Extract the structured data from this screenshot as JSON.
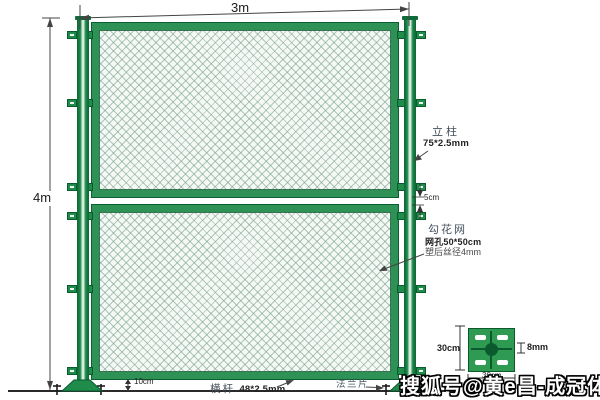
{
  "fence_dimensions": {
    "width": "3m",
    "height": "4m",
    "panel_gap": "5cm",
    "ground_clearance": "10cm"
  },
  "callouts": {
    "post_title": "立柱",
    "post_spec": "75*2.5mm",
    "mesh_title": "勾花网",
    "mesh_spec_opening": "网孔50*50cm",
    "mesh_spec_wire": "塑后丝径4mm",
    "rail_title": "横杆",
    "rail_spec": "48*2.5mm",
    "flange_title": "法兰片"
  },
  "flange_detail": {
    "height": "30cm",
    "width": "30cm",
    "thickness": "8mm"
  },
  "watermark": "搜狐号@黄e昌-成冠体育",
  "colors": {
    "post_green": "#1e8a4a",
    "frame_green": "#2e9155",
    "plate_green": "#2f9b52",
    "outline_green": "#0a5a2e",
    "mesh_line": "#739b87",
    "dim_line": "#444444"
  }
}
